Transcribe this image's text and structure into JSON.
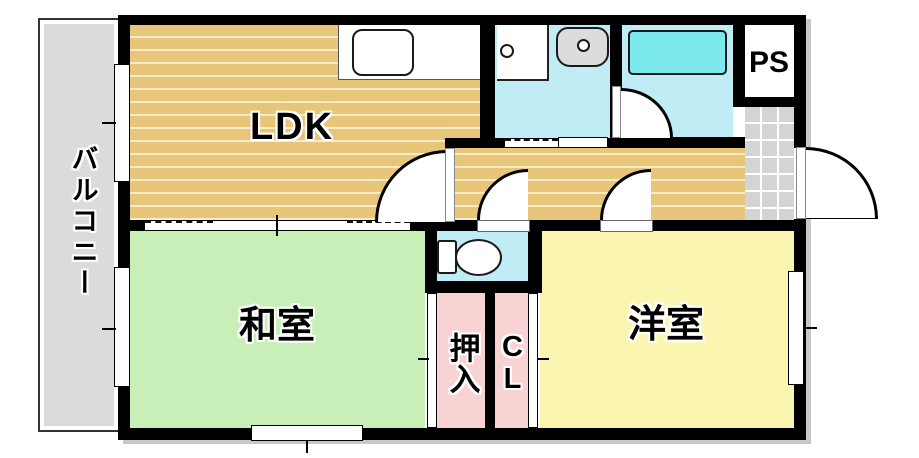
{
  "plan_type": "apartment-floor-plan",
  "rooms": {
    "balcony": {
      "label": "バルコニー"
    },
    "ldk": {
      "label": "LDK"
    },
    "japanese_room": {
      "label": "和室"
    },
    "western_room": {
      "label": "洋室"
    },
    "oshiire_closet": {
      "label": "押入"
    },
    "closet": {
      "label": "CL"
    },
    "pipe_space": {
      "label": "PS"
    }
  },
  "fixtures": [
    "kitchen-counter",
    "kitchen-sink",
    "washing-machine-pan",
    "washbasin",
    "bathtub",
    "toilet"
  ],
  "colors": {
    "wall": "#000000",
    "ldk_floor": "#e7c67a",
    "ldk_stripe": "#f6ecca",
    "japanese_floor": "#c8efb8",
    "western_floor": "#faf6b2",
    "wet_floor": "#bfecf5",
    "bathtub_fill": "#7ce9ee",
    "closet_floor": "#f7d3d3",
    "balcony_floor": "#dbdbdb",
    "tile_floor": "#d4d4d4",
    "fixture_gray": "#dcdcdc",
    "shadow": "#c8c8c8"
  }
}
